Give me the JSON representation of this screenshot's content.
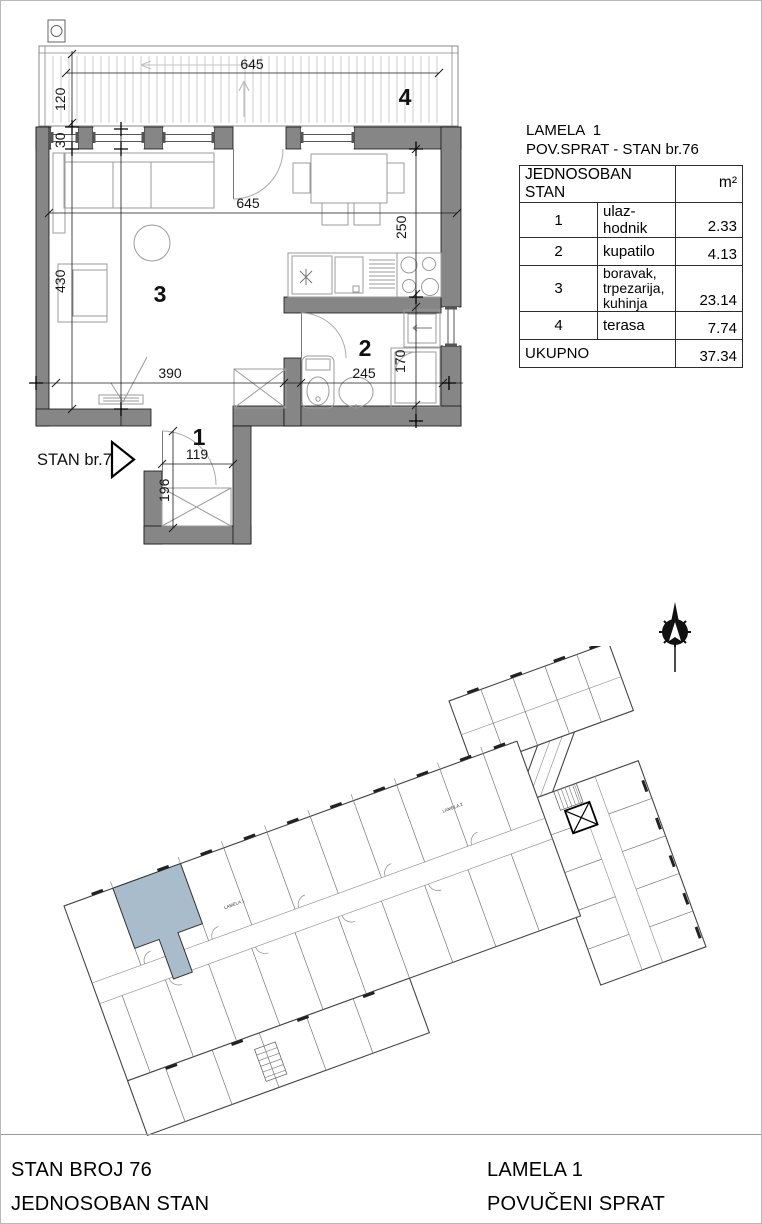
{
  "info_panel": {
    "title_line1": "LAMELA  1",
    "title_line2": "POV.SPRAT - STAN br.76",
    "table": {
      "header_name": "JEDNOSOBAN STAN",
      "header_unit": "m²",
      "rows": [
        {
          "num": "1",
          "name": "ulaz-hodnik",
          "name2": "",
          "area": "2.33"
        },
        {
          "num": "2",
          "name": "kupatilo",
          "name2": "",
          "area": "4.13"
        },
        {
          "num": "3",
          "name": "boravak, trpezarija,",
          "name2": "kuhinja",
          "area": "23.14"
        },
        {
          "num": "4",
          "name": "terasa",
          "name2": "",
          "area": "7.74"
        }
      ],
      "total_label": "UKUPNO",
      "total_value": "37.34"
    }
  },
  "unit_plan": {
    "arrow_label": "STAN br.76",
    "rooms": {
      "hall": "1",
      "bath": "2",
      "living": "3",
      "terrace": "4"
    },
    "dims": {
      "terrace_width": "645",
      "terrace_depth": "120",
      "wall": "30",
      "living_height": "430",
      "inner_width": "645",
      "kitchen_depth": "250",
      "living_width": "390",
      "bath_width": "245",
      "bath_height": "170",
      "hall_width": "119",
      "hall_depth": "196"
    }
  },
  "site_plan": {
    "label_lamela1": "LAMELA 1",
    "label_lamela2": "LAMELA 2",
    "highlight_color": "#a8bccb"
  },
  "footer": {
    "left_line1": "STAN BROJ 76",
    "left_line2": "JEDNOSOBAN STAN",
    "right_line1": "LAMELA  1",
    "right_line2": "POVUČENI SPRAT"
  }
}
